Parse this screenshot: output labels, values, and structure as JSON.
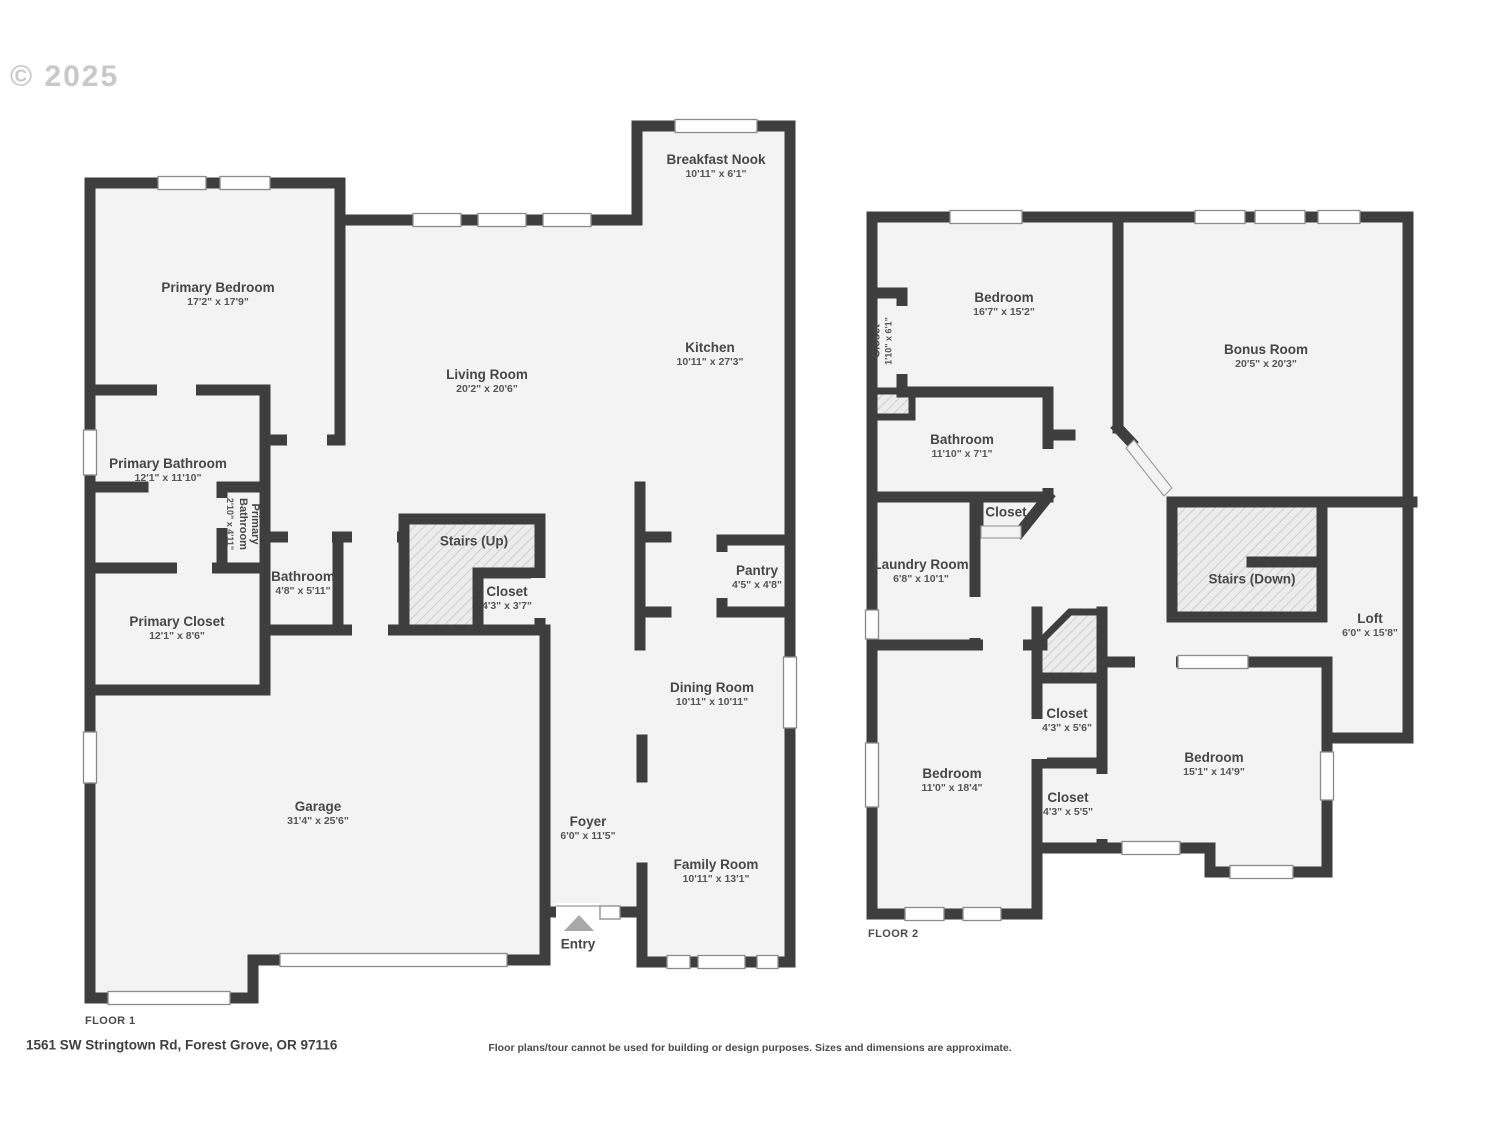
{
  "copyright": "© 2025",
  "footer": {
    "address": "1561 SW Stringtown Rd, Forest Grove, OR 97116",
    "disclaimer": "Floor plans/tour cannot be used for building or design purposes. Sizes and dimensions are approximate."
  },
  "colors": {
    "wall": "#3e3e3e",
    "floor": "#f3f3f3",
    "hatch_bg": "#ececec",
    "hatch_line": "#bdbdbd",
    "window_stroke": "#8a8a8a",
    "opening_stroke": "#9a9a9a",
    "entry_arrow": "#a8a8a8",
    "label_text": "#474747"
  },
  "floor1": {
    "label": "FLOOR 1",
    "rooms": [
      {
        "name": "Breakfast Nook",
        "dims": "10'11\" x 6'1\"",
        "x": 716,
        "y": 166
      },
      {
        "name": "Primary Bedroom",
        "dims": "17'2\" x 17'9\"",
        "x": 218,
        "y": 294
      },
      {
        "name": "Living Room",
        "dims": "20'2\" x 20'6\"",
        "x": 487,
        "y": 381
      },
      {
        "name": "Kitchen",
        "dims": "10'11\" x 27'3\"",
        "x": 710,
        "y": 354
      },
      {
        "name": "Primary Bathroom",
        "dims": "12'1\" x 11'10\"",
        "x": 168,
        "y": 470
      },
      {
        "name": "Primary\nBathroom",
        "dims": "2'10\" x 4'11\"",
        "x": 243,
        "y": 524,
        "rot": 90,
        "small": true
      },
      {
        "name": "Bathroom",
        "dims": "4'8\" x 5'11\"",
        "x": 303,
        "y": 583
      },
      {
        "name": "Stairs (Up)",
        "dims": "",
        "x": 474,
        "y": 541
      },
      {
        "name": "Closet",
        "dims": "4'3\" x 3'7\"",
        "x": 507,
        "y": 598
      },
      {
        "name": "Primary Closet",
        "dims": "12'1\" x 8'6\"",
        "x": 177,
        "y": 628
      },
      {
        "name": "Pantry",
        "dims": "4'5\" x 4'8\"",
        "x": 757,
        "y": 577
      },
      {
        "name": "Dining Room",
        "dims": "10'11\" x 10'11\"",
        "x": 712,
        "y": 694
      },
      {
        "name": "Garage",
        "dims": "31'4\" x 25'6\"",
        "x": 318,
        "y": 813
      },
      {
        "name": "Foyer",
        "dims": "6'0\" x 11'5\"",
        "x": 588,
        "y": 828
      },
      {
        "name": "Family Room",
        "dims": "10'11\" x 13'1\"",
        "x": 716,
        "y": 871
      },
      {
        "name": "Entry",
        "dims": "",
        "x": 578,
        "y": 944
      }
    ]
  },
  "floor2": {
    "label": "FLOOR 2",
    "rooms": [
      {
        "name": "Bedroom",
        "dims": "16'7\" x 15'2\"",
        "x": 1004,
        "y": 304
      },
      {
        "name": "Bonus Room",
        "dims": "20'5\" x 20'3\"",
        "x": 1266,
        "y": 356
      },
      {
        "name": "Closet",
        "dims": "1'10\" x 6'1\"",
        "x": 882,
        "y": 341,
        "rot": -90,
        "small": true
      },
      {
        "name": "Bathroom",
        "dims": "11'10\" x 7'1\"",
        "x": 962,
        "y": 446
      },
      {
        "name": "Closet",
        "dims": "",
        "x": 1006,
        "y": 512
      },
      {
        "name": "Laundry Room",
        "dims": "6'8\" x 10'1\"",
        "x": 921,
        "y": 571
      },
      {
        "name": "Stairs (Down)",
        "dims": "",
        "x": 1252,
        "y": 579
      },
      {
        "name": "Loft",
        "dims": "6'0\" x 15'8\"",
        "x": 1370,
        "y": 625
      },
      {
        "name": "Closet",
        "dims": "4'3\" x 5'6\"",
        "x": 1067,
        "y": 720
      },
      {
        "name": "Closet",
        "dims": "4'3\" x 5'5\"",
        "x": 1068,
        "y": 804
      },
      {
        "name": "Bedroom",
        "dims": "11'0\" x 18'4\"",
        "x": 952,
        "y": 780
      },
      {
        "name": "Bedroom",
        "dims": "15'1\" x 14'9\"",
        "x": 1214,
        "y": 764
      }
    ]
  }
}
